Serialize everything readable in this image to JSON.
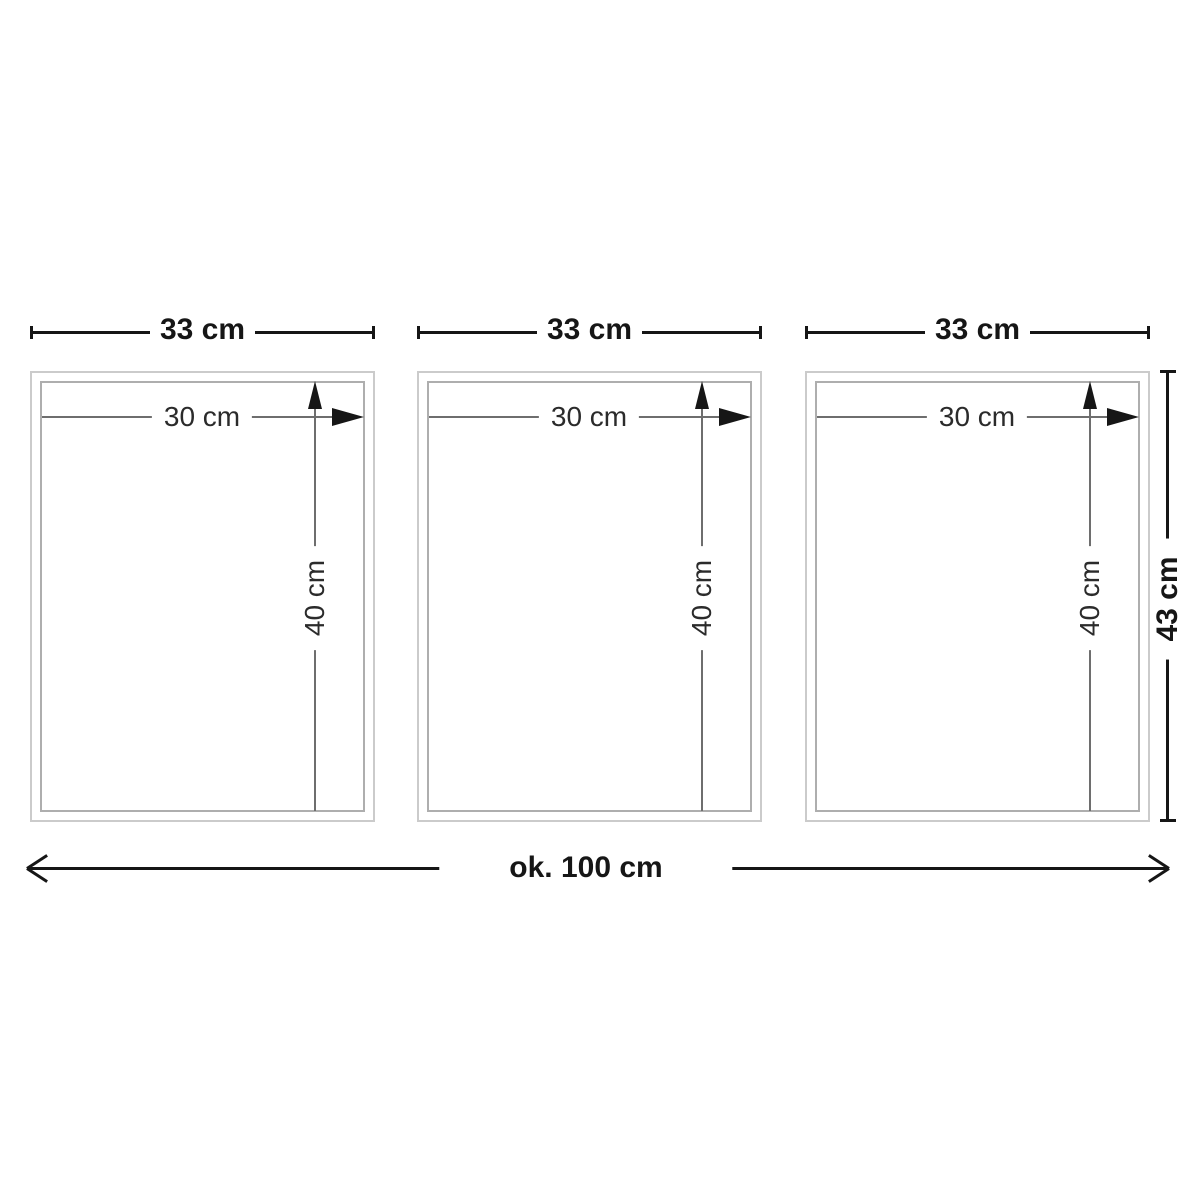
{
  "diagram": {
    "frames": [
      {
        "width_label": "33 cm",
        "inner_width_label": "30 cm",
        "inner_height_label": "40 cm"
      },
      {
        "width_label": "33 cm",
        "inner_width_label": "30 cm",
        "inner_height_label": "40 cm"
      },
      {
        "width_label": "33 cm",
        "inner_width_label": "30 cm",
        "inner_height_label": "40 cm"
      }
    ],
    "total_width_label": "ok. 100 cm",
    "total_height_label": "43 cm"
  },
  "colors": {
    "background": "#ffffff",
    "line_black": "#161616",
    "thin_line": "#6e6e6e",
    "frame_outer_border": "#cbcbcb",
    "frame_inner_border": "#aeaeae",
    "label_text": "#161616",
    "inner_label_text": "#2b2b2b"
  }
}
